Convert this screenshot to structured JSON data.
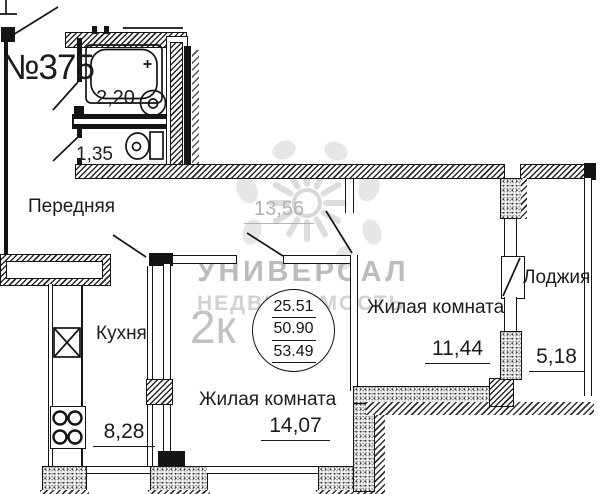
{
  "plan": {
    "apartment_number": "№375",
    "summary": {
      "type": "2к",
      "living_area": "25.51",
      "usable_area": "50.90",
      "total_area": "53.49"
    },
    "bathroom": {
      "area": "2,20"
    },
    "toilet": {
      "area": "1,35"
    },
    "hallway": {
      "label": "Передняя",
      "area": "13,56"
    },
    "kitchen": {
      "label": "Кухня",
      "area": "8,28"
    },
    "living_room_1": {
      "label": "Жилая комната",
      "area": "14,07"
    },
    "living_room_2": {
      "label": "Жилая комната",
      "area": "11,44"
    },
    "loggia": {
      "label": "Лоджия",
      "area": "5,18"
    },
    "watermark": {
      "line1": "УНИВЕРСАЛ",
      "line2": "НЕДВИЖИМОСТЬ"
    },
    "colors": {
      "line": "#141414",
      "muted_label": "#b3b3b3",
      "watermark_text": "#bcbcbc"
    }
  }
}
